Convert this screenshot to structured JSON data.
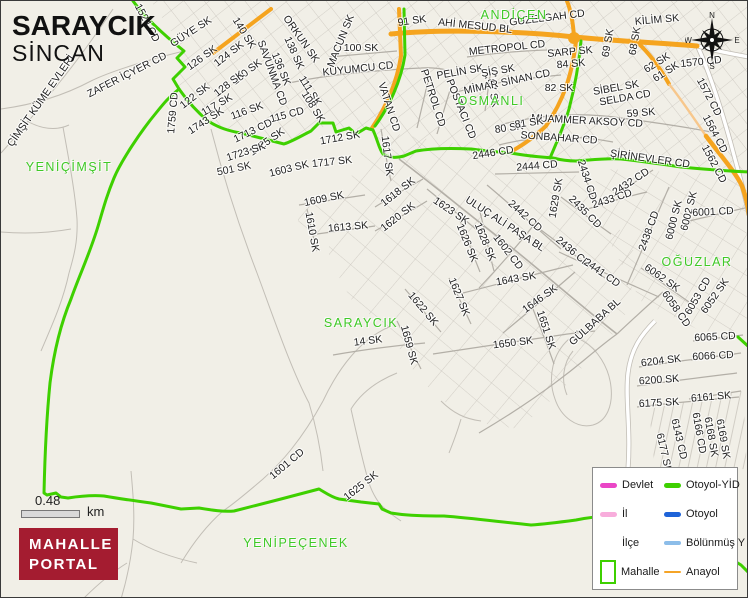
{
  "title": {
    "mahalle": "SARAYCIK",
    "district": "SİNCAN"
  },
  "colors": {
    "bg": "#f1efe7",
    "road_gray": "#c2beb6",
    "road_gray_dark": "#b3afa7",
    "anayol": "#f5a41f",
    "anayol_light": "#f7c78c",
    "boundary_green": "#3ed000",
    "area_label": "#3fc926",
    "label_dark": "#222222",
    "legend_border": "#8b8b8b",
    "logo_red": "#a41c30"
  },
  "compass": {
    "n": "N",
    "e": "E",
    "s": "S",
    "w": "W"
  },
  "scale_bar": {
    "value": "0.48",
    "unit": "km"
  },
  "logo": {
    "line1": "MAHALLE",
    "line2": "PORTAL"
  },
  "legend": {
    "items": [
      {
        "label": "Devlet",
        "swatch": "line",
        "color": "#ea46c6",
        "thickness": 5
      },
      {
        "label": "Otoyol-YİD",
        "swatch": "line",
        "color": "#3ed000",
        "thickness": 5
      },
      {
        "label": "İl",
        "swatch": "line",
        "color": "#f8addc",
        "thickness": 5
      },
      {
        "label": "Otoyol",
        "swatch": "line",
        "color": "#1e63d8",
        "thickness": 5
      },
      {
        "label": "İlçe",
        "swatch": "none",
        "color": "",
        "thickness": 0
      },
      {
        "label": "Bölünmüş Y",
        "swatch": "line",
        "color": "#8cbde9",
        "thickness": 4
      },
      {
        "label": "Mahalle",
        "swatch": "rect",
        "color": "#3ed000",
        "thickness": 2
      },
      {
        "label": "Anayol",
        "swatch": "line",
        "color": "#f5a427",
        "thickness": 2
      }
    ]
  },
  "area_labels": [
    {
      "t": "ANDİÇEN",
      "x": 513,
      "y": 14
    },
    {
      "t": "OSMANLI",
      "x": 490,
      "y": 100
    },
    {
      "t": "YENİÇİMŞİT",
      "x": 68,
      "y": 166
    },
    {
      "t": "SARAYCIK",
      "x": 360,
      "y": 322
    },
    {
      "t": "OĞUZLAR",
      "x": 696,
      "y": 261
    },
    {
      "t": "YENİPEÇENEK",
      "x": 295,
      "y": 542
    }
  ],
  "street_labels": [
    {
      "t": "1524 CD",
      "x": 146,
      "y": 22,
      "r": 62
    },
    {
      "t": "GÜYE SK",
      "x": 190,
      "y": 31,
      "r": -33
    },
    {
      "t": "126 SK",
      "x": 201,
      "y": 57,
      "r": -36
    },
    {
      "t": "124 SK",
      "x": 228,
      "y": 53,
      "r": -38
    },
    {
      "t": "140 SK",
      "x": 243,
      "y": 32,
      "r": 58
    },
    {
      "t": "SAVUNMA CD",
      "x": 271,
      "y": 72,
      "r": 70
    },
    {
      "t": "138 SK",
      "x": 293,
      "y": 52,
      "r": 66
    },
    {
      "t": "136 SK",
      "x": 280,
      "y": 68,
      "r": 68
    },
    {
      "t": "ORKUN SK",
      "x": 300,
      "y": 38,
      "r": 55
    },
    {
      "t": "MACUN SK",
      "x": 340,
      "y": 40,
      "r": -68
    },
    {
      "t": "100 SK",
      "x": 360,
      "y": 47,
      "r": 0
    },
    {
      "t": "91 SK",
      "x": 411,
      "y": 20,
      "r": -8
    },
    {
      "t": "AHİ MESUD BL",
      "x": 474,
      "y": 25,
      "r": 6
    },
    {
      "t": "KUYUMCU CD",
      "x": 357,
      "y": 68,
      "r": -6
    },
    {
      "t": "111 SK",
      "x": 309,
      "y": 90,
      "r": 58
    },
    {
      "t": "108 SK",
      "x": 312,
      "y": 106,
      "r": 58
    },
    {
      "t": "130 SK",
      "x": 246,
      "y": 71,
      "r": -38
    },
    {
      "t": "128 SK",
      "x": 228,
      "y": 83,
      "r": -38
    },
    {
      "t": "122 SK",
      "x": 194,
      "y": 95,
      "r": -38
    },
    {
      "t": "117 SK",
      "x": 216,
      "y": 104,
      "r": -30
    },
    {
      "t": "116 SK",
      "x": 246,
      "y": 110,
      "r": -20
    },
    {
      "t": "115 CD",
      "x": 286,
      "y": 114,
      "r": -15
    },
    {
      "t": "1743 SK",
      "x": 205,
      "y": 120,
      "r": -33
    },
    {
      "t": "1759 CD",
      "x": 172,
      "y": 112,
      "r": -85
    },
    {
      "t": "ZAFER İÇYER CD",
      "x": 126,
      "y": 74,
      "r": -27
    },
    {
      "t": "ÇİMŞİT KÜME EVLERİ",
      "x": 40,
      "y": 100,
      "r": -55
    },
    {
      "t": "VATAN CD",
      "x": 388,
      "y": 106,
      "r": 72
    },
    {
      "t": "PETROL CD",
      "x": 432,
      "y": 97,
      "r": 72
    },
    {
      "t": "POSTACI CD",
      "x": 460,
      "y": 108,
      "r": 68
    },
    {
      "t": "87 SK",
      "x": 492,
      "y": 92,
      "r": 80
    },
    {
      "t": "PELİN SK",
      "x": 459,
      "y": 71,
      "r": -10
    },
    {
      "t": "ŞİŞ SK",
      "x": 497,
      "y": 70,
      "r": -10
    },
    {
      "t": "MİMAR SİNAN CD",
      "x": 506,
      "y": 81,
      "r": -12
    },
    {
      "t": "METROPOL CD",
      "x": 506,
      "y": 47,
      "r": -6
    },
    {
      "t": "SARP SK",
      "x": 569,
      "y": 51,
      "r": -5
    },
    {
      "t": "84 SK",
      "x": 570,
      "y": 63,
      "r": -5
    },
    {
      "t": "GUZELGAH CD",
      "x": 546,
      "y": 17,
      "r": -7
    },
    {
      "t": "KİLİM SK",
      "x": 656,
      "y": 19,
      "r": -5
    },
    {
      "t": "69 SK",
      "x": 607,
      "y": 42,
      "r": -80
    },
    {
      "t": "68 SK",
      "x": 634,
      "y": 40,
      "r": -80
    },
    {
      "t": "62 SK",
      "x": 656,
      "y": 62,
      "r": -32
    },
    {
      "t": "61 SK",
      "x": 665,
      "y": 71,
      "r": -32
    },
    {
      "t": "82 SK",
      "x": 558,
      "y": 87,
      "r": 0
    },
    {
      "t": "SİBEL SK",
      "x": 615,
      "y": 87,
      "r": -10
    },
    {
      "t": "SELDA CD",
      "x": 624,
      "y": 97,
      "r": -10
    },
    {
      "t": "1570 CD",
      "x": 700,
      "y": 61,
      "r": -6
    },
    {
      "t": "1572 CD",
      "x": 708,
      "y": 96,
      "r": 62
    },
    {
      "t": "1564 CD",
      "x": 714,
      "y": 133,
      "r": 62
    },
    {
      "t": "1562 CD",
      "x": 713,
      "y": 163,
      "r": 62
    },
    {
      "t": "59 SK",
      "x": 640,
      "y": 112,
      "r": -5
    },
    {
      "t": "MUAMMER AKSOY CD",
      "x": 586,
      "y": 120,
      "r": 3
    },
    {
      "t": "SONBAHAR CD",
      "x": 558,
      "y": 137,
      "r": 4
    },
    {
      "t": "80 SK",
      "x": 508,
      "y": 127,
      "r": -8
    },
    {
      "t": "81 SK",
      "x": 528,
      "y": 122,
      "r": -8
    },
    {
      "t": "ŞİRİNEVLER CD",
      "x": 649,
      "y": 158,
      "r": 8
    },
    {
      "t": "2446 CD",
      "x": 492,
      "y": 152,
      "r": -9
    },
    {
      "t": "2444 CD",
      "x": 536,
      "y": 165,
      "r": -5
    },
    {
      "t": "1712 SK",
      "x": 339,
      "y": 137,
      "r": -10
    },
    {
      "t": "1713 CD",
      "x": 252,
      "y": 130,
      "r": -26
    },
    {
      "t": "1725 SK",
      "x": 266,
      "y": 141,
      "r": -35
    },
    {
      "t": "1723 SK",
      "x": 245,
      "y": 151,
      "r": -18
    },
    {
      "t": "501 SK",
      "x": 233,
      "y": 168,
      "r": -12
    },
    {
      "t": "1603 SK",
      "x": 288,
      "y": 168,
      "r": -14
    },
    {
      "t": "1717 SK",
      "x": 331,
      "y": 161,
      "r": -6
    },
    {
      "t": "1617 SK",
      "x": 386,
      "y": 155,
      "r": 83
    },
    {
      "t": "1609 SK",
      "x": 323,
      "y": 198,
      "r": -12
    },
    {
      "t": "1610 SK",
      "x": 311,
      "y": 231,
      "r": 80
    },
    {
      "t": "1613 SK",
      "x": 347,
      "y": 226,
      "r": -5
    },
    {
      "t": "1618 SK",
      "x": 397,
      "y": 191,
      "r": -38
    },
    {
      "t": "1620 SK",
      "x": 397,
      "y": 216,
      "r": -38
    },
    {
      "t": "1623 SK",
      "x": 450,
      "y": 210,
      "r": 34
    },
    {
      "t": "1626 SK",
      "x": 466,
      "y": 242,
      "r": 68
    },
    {
      "t": "1628 SK",
      "x": 484,
      "y": 241,
      "r": 68
    },
    {
      "t": "1602 CD",
      "x": 507,
      "y": 251,
      "r": 52
    },
    {
      "t": "ULUÇ ALİ PAŞA BL",
      "x": 504,
      "y": 223,
      "r": 33
    },
    {
      "t": "2442 CD",
      "x": 524,
      "y": 215,
      "r": 42
    },
    {
      "t": "2435 CD",
      "x": 584,
      "y": 211,
      "r": 45
    },
    {
      "t": "2434 CD",
      "x": 586,
      "y": 179,
      "r": 72
    },
    {
      "t": "2433 CD",
      "x": 611,
      "y": 198,
      "r": -18
    },
    {
      "t": "2432 CD",
      "x": 630,
      "y": 181,
      "r": -33
    },
    {
      "t": "1629 SK",
      "x": 555,
      "y": 197,
      "r": -80
    },
    {
      "t": "2436 CD",
      "x": 572,
      "y": 251,
      "r": 40
    },
    {
      "t": "2441 CD",
      "x": 601,
      "y": 272,
      "r": 35
    },
    {
      "t": "2438 CD",
      "x": 648,
      "y": 230,
      "r": -70
    },
    {
      "t": "6000 SK",
      "x": 673,
      "y": 219,
      "r": -76
    },
    {
      "t": "6002 SK",
      "x": 688,
      "y": 210,
      "r": -76
    },
    {
      "t": "6001 CD",
      "x": 712,
      "y": 211,
      "r": -3
    },
    {
      "t": "6062 SK",
      "x": 661,
      "y": 277,
      "r": 35
    },
    {
      "t": "6058 CD",
      "x": 675,
      "y": 308,
      "r": 55
    },
    {
      "t": "6053 CD",
      "x": 697,
      "y": 295,
      "r": -60
    },
    {
      "t": "6052 SK",
      "x": 714,
      "y": 295,
      "r": -55
    },
    {
      "t": "6065 CD",
      "x": 714,
      "y": 336,
      "r": -3
    },
    {
      "t": "6066 CD",
      "x": 712,
      "y": 355,
      "r": -3
    },
    {
      "t": "1643 SK",
      "x": 515,
      "y": 278,
      "r": -10
    },
    {
      "t": "1646 SK",
      "x": 539,
      "y": 298,
      "r": -36
    },
    {
      "t": "1651 SK",
      "x": 545,
      "y": 329,
      "r": 72
    },
    {
      "t": "1650 SK",
      "x": 512,
      "y": 342,
      "r": -7
    },
    {
      "t": "14 SK",
      "x": 367,
      "y": 340,
      "r": -7
    },
    {
      "t": "1622 SK",
      "x": 422,
      "y": 308,
      "r": 50
    },
    {
      "t": "1627 SK",
      "x": 458,
      "y": 296,
      "r": 68
    },
    {
      "t": "1659 SK",
      "x": 408,
      "y": 344,
      "r": 75
    },
    {
      "t": "GÜLBABA BL",
      "x": 594,
      "y": 321,
      "r": -42
    },
    {
      "t": "6204 SK",
      "x": 660,
      "y": 360,
      "r": -7
    },
    {
      "t": "6200 SK",
      "x": 658,
      "y": 379,
      "r": -4
    },
    {
      "t": "6175 SK",
      "x": 658,
      "y": 402,
      "r": -3
    },
    {
      "t": "6161 SK",
      "x": 710,
      "y": 396,
      "r": -5
    },
    {
      "t": "6143 CD",
      "x": 678,
      "y": 438,
      "r": 77
    },
    {
      "t": "6177 SK",
      "x": 663,
      "y": 452,
      "r": 77
    },
    {
      "t": "6166 CD",
      "x": 698,
      "y": 432,
      "r": 80
    },
    {
      "t": "6168 SK",
      "x": 710,
      "y": 436,
      "r": 80
    },
    {
      "t": "6169 SK",
      "x": 722,
      "y": 438,
      "r": 80
    },
    {
      "t": "1601 CD",
      "x": 286,
      "y": 463,
      "r": -40
    },
    {
      "t": "1625 SK",
      "x": 360,
      "y": 485,
      "r": -38
    }
  ]
}
